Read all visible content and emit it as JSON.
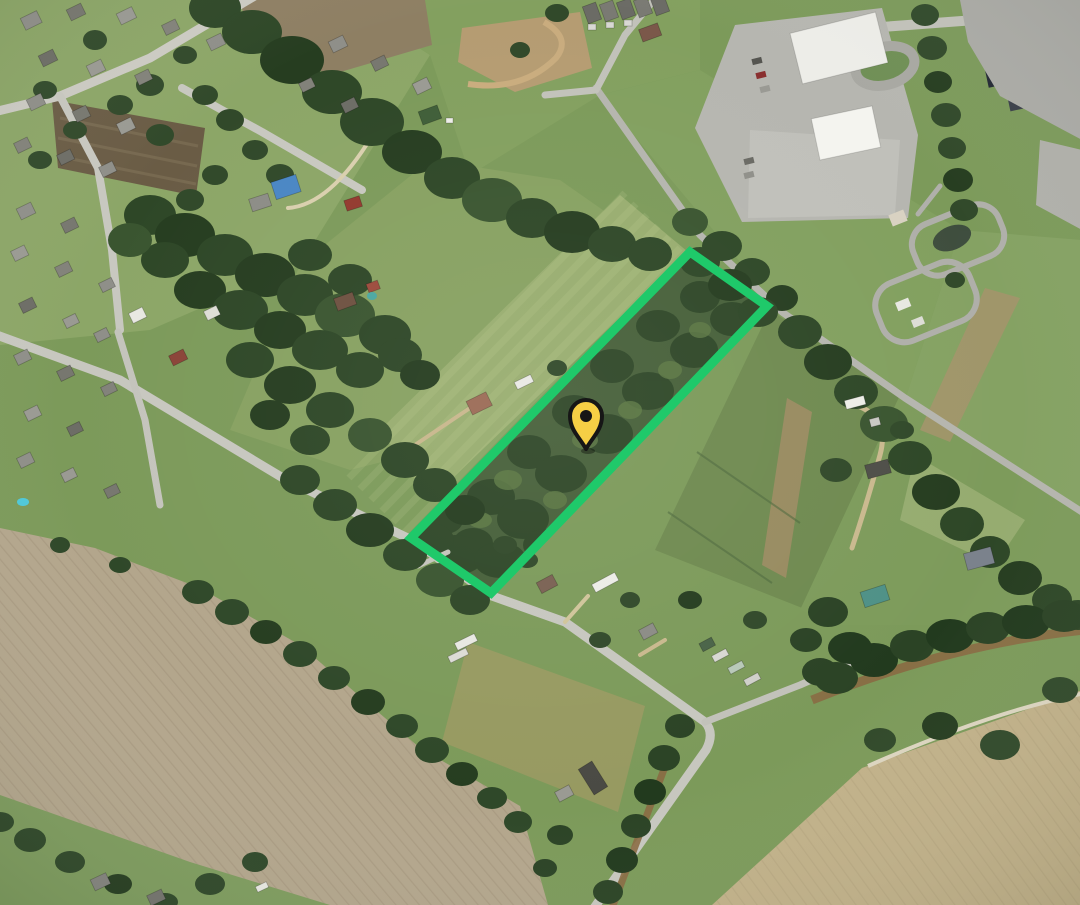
{
  "map": {
    "type": "satellite-oblique-aerial",
    "parcel_boundary": {
      "points": "690,252 767,306 491,593 411,538",
      "stroke_color": "#1fc96a",
      "stroke_width": "9"
    },
    "location_pin": {
      "x": 586,
      "y": 449,
      "transform": "translate(586,449)",
      "fill_color": "#f6cf45",
      "outline_color": "#161616"
    }
  }
}
